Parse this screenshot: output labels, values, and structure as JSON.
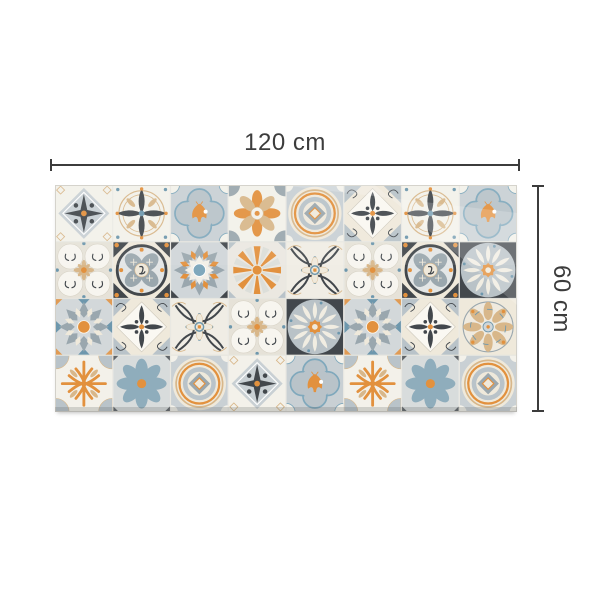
{
  "dimensions": {
    "width_label": "120 cm",
    "height_label": "60 cm"
  },
  "rug": {
    "cols": 8,
    "rows": 4,
    "grid": [
      [
        "star-diamond",
        "cross-rings",
        "moth",
        "petal8",
        "medallion",
        "diamond-scroll",
        "cross-rings",
        "moth"
      ],
      [
        "scroll-circles",
        "ring-medallion",
        "rosette-blue",
        "sunburst",
        "arcs-cross",
        "scroll-circles",
        "ring-medallion",
        "cream-daisy"
      ],
      [
        "rosette-orange",
        "diamond-scroll",
        "arcs-cross",
        "scroll-circles",
        "cream-daisy",
        "rosette-orange",
        "diamond-scroll",
        "fan-medallion"
      ],
      [
        "coral-cross",
        "blue-daisy",
        "medallion",
        "star-diamond",
        "moth",
        "coral-cross",
        "blue-daisy",
        "medallion"
      ]
    ]
  },
  "colors": {
    "charcoal": "#42474c",
    "slate": "#9aa7ae",
    "slateLight": "#b9c3c9",
    "grayblue": "#c9d0d4",
    "blue": "#7fa8bc",
    "steel": "#6d97ad",
    "orange": "#e2913e",
    "tan": "#d8b78a",
    "cream": "#efe9db",
    "offwhite": "#f3f1ea",
    "seam": "#e7e5df",
    "dimline": "#3c3c3c"
  }
}
